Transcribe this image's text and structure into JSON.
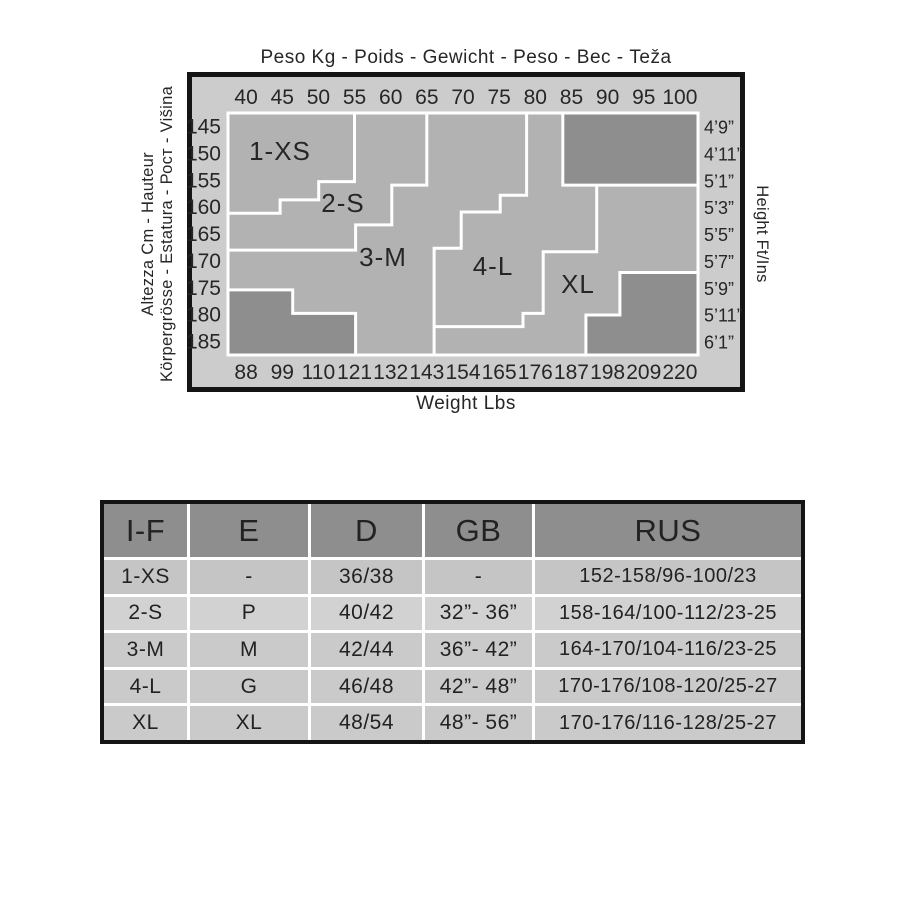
{
  "colors": {
    "chart_background": "#cccccc",
    "plot_background": "#b2b2b2",
    "dark_zone": "#8e8e8e",
    "boundary_line": "#ffffff",
    "frame": "#141414",
    "table_header_bg": "#8e8e8e",
    "table_row_bgs": [
      "#c5c5c5",
      "#d2d2d2",
      "#cacaca",
      "#cacaca",
      "#cacaca"
    ],
    "text": "#262626"
  },
  "chart": {
    "title": "Peso Kg - Poids - Gewicht - Peso - Вес - Teža",
    "bottom_axis_title": "Weight Lbs",
    "left_axis_title_line1": "Altezza Cm - Hauteur",
    "left_axis_title_line2": "Körpergrösse - Estatura - Рост - Višina",
    "right_axis_title": "Height Ft/Ins",
    "kg_labels": [
      40,
      45,
      50,
      55,
      60,
      65,
      70,
      75,
      80,
      85,
      90,
      95,
      100
    ],
    "lbs_labels": [
      88,
      99,
      110,
      121,
      132,
      143,
      154,
      165,
      176,
      187,
      198,
      209,
      220
    ],
    "cm_labels": [
      145,
      150,
      155,
      160,
      165,
      170,
      175,
      180,
      185
    ],
    "ftins_labels": [
      "4’9”",
      "4’11”",
      "5’1”",
      "5’3”",
      "5’5”",
      "5’7”",
      "5’9”",
      "5’11”",
      "6’1”"
    ],
    "size_labels": [
      "1-XS",
      "2-S",
      "3-M",
      "4-L",
      "XL"
    ]
  },
  "chart_data": [
    {
      "type": "heatmap",
      "title": "Peso Kg - Poids - Gewicht - Peso - Вес - Teža",
      "xlabel": "Weight Lbs",
      "ylabel": "Altezza Cm - Hauteur / Körpergrösse - Estatura - Рост - Višina",
      "y2label": "Height Ft/Ins",
      "x_kg": [
        40,
        45,
        50,
        55,
        60,
        65,
        70,
        75,
        80,
        85,
        90,
        95,
        100
      ],
      "x_lbs": [
        88,
        99,
        110,
        121,
        132,
        143,
        154,
        165,
        176,
        187,
        198,
        209,
        220
      ],
      "y_cm": [
        145,
        150,
        155,
        160,
        165,
        170,
        175,
        180,
        185
      ],
      "y_ftins": [
        "4’9”",
        "4’11”",
        "5’1”",
        "5’3”",
        "5’5”",
        "5’7”",
        "5’9”",
        "5’11”",
        "6’1”"
      ],
      "zones": [
        {
          "label": "1-XS",
          "approx_kg_range": [
            40,
            55
          ],
          "approx_cm_range": [
            145,
            162
          ]
        },
        {
          "label": "2-S",
          "approx_kg_range": [
            42,
            65
          ],
          "approx_cm_range": [
            145,
            170
          ]
        },
        {
          "label": "3-M",
          "approx_kg_range": [
            50,
            80
          ],
          "approx_cm_range": [
            145,
            185
          ]
        },
        {
          "label": "4-L",
          "approx_kg_range": [
            60,
            92
          ],
          "approx_cm_range": [
            145,
            185
          ]
        },
        {
          "label": "XL",
          "approx_kg_range": [
            78,
            100
          ],
          "approx_cm_range": [
            155,
            185
          ]
        }
      ],
      "excluded_dark_corners": [
        "top-right",
        "bottom-left",
        "bottom-right"
      ],
      "legend_position": "none",
      "grid": false
    },
    {
      "type": "table",
      "title": "Size conversion table",
      "headers": [
        "I-F",
        "E",
        "D",
        "GB",
        "RUS"
      ],
      "rows": [
        [
          "1-XS",
          "-",
          "36/38",
          "-",
          "152-158/96-100/23"
        ],
        [
          "2-S",
          "P",
          "40/42",
          "32”- 36”",
          "158-164/100-112/23-25"
        ],
        [
          "3-M",
          "M",
          "42/44",
          "36”- 42”",
          "164-170/104-116/23-25"
        ],
        [
          "4-L",
          "G",
          "46/48",
          "42”- 48”",
          "170-176/108-120/25-27"
        ],
        [
          "XL",
          "XL",
          "48/54",
          "48”- 56”",
          "170-176/116-128/25-27"
        ]
      ]
    }
  ],
  "table": {
    "headers": [
      "I-F",
      "E",
      "D",
      "GB",
      "RUS"
    ],
    "rows": [
      [
        "1-XS",
        "-",
        "36/38",
        "-",
        "152-158/96-100/23"
      ],
      [
        "2-S",
        "P",
        "40/42",
        "32”- 36”",
        "158-164/100-112/23-25"
      ],
      [
        "3-M",
        "M",
        "42/44",
        "36”- 42”",
        "164-170/104-116/23-25"
      ],
      [
        "4-L",
        "G",
        "46/48",
        "42”- 48”",
        "170-176/108-120/25-27"
      ],
      [
        "XL",
        "XL",
        "48/54",
        "48”- 56”",
        "170-176/116-128/25-27"
      ]
    ]
  }
}
